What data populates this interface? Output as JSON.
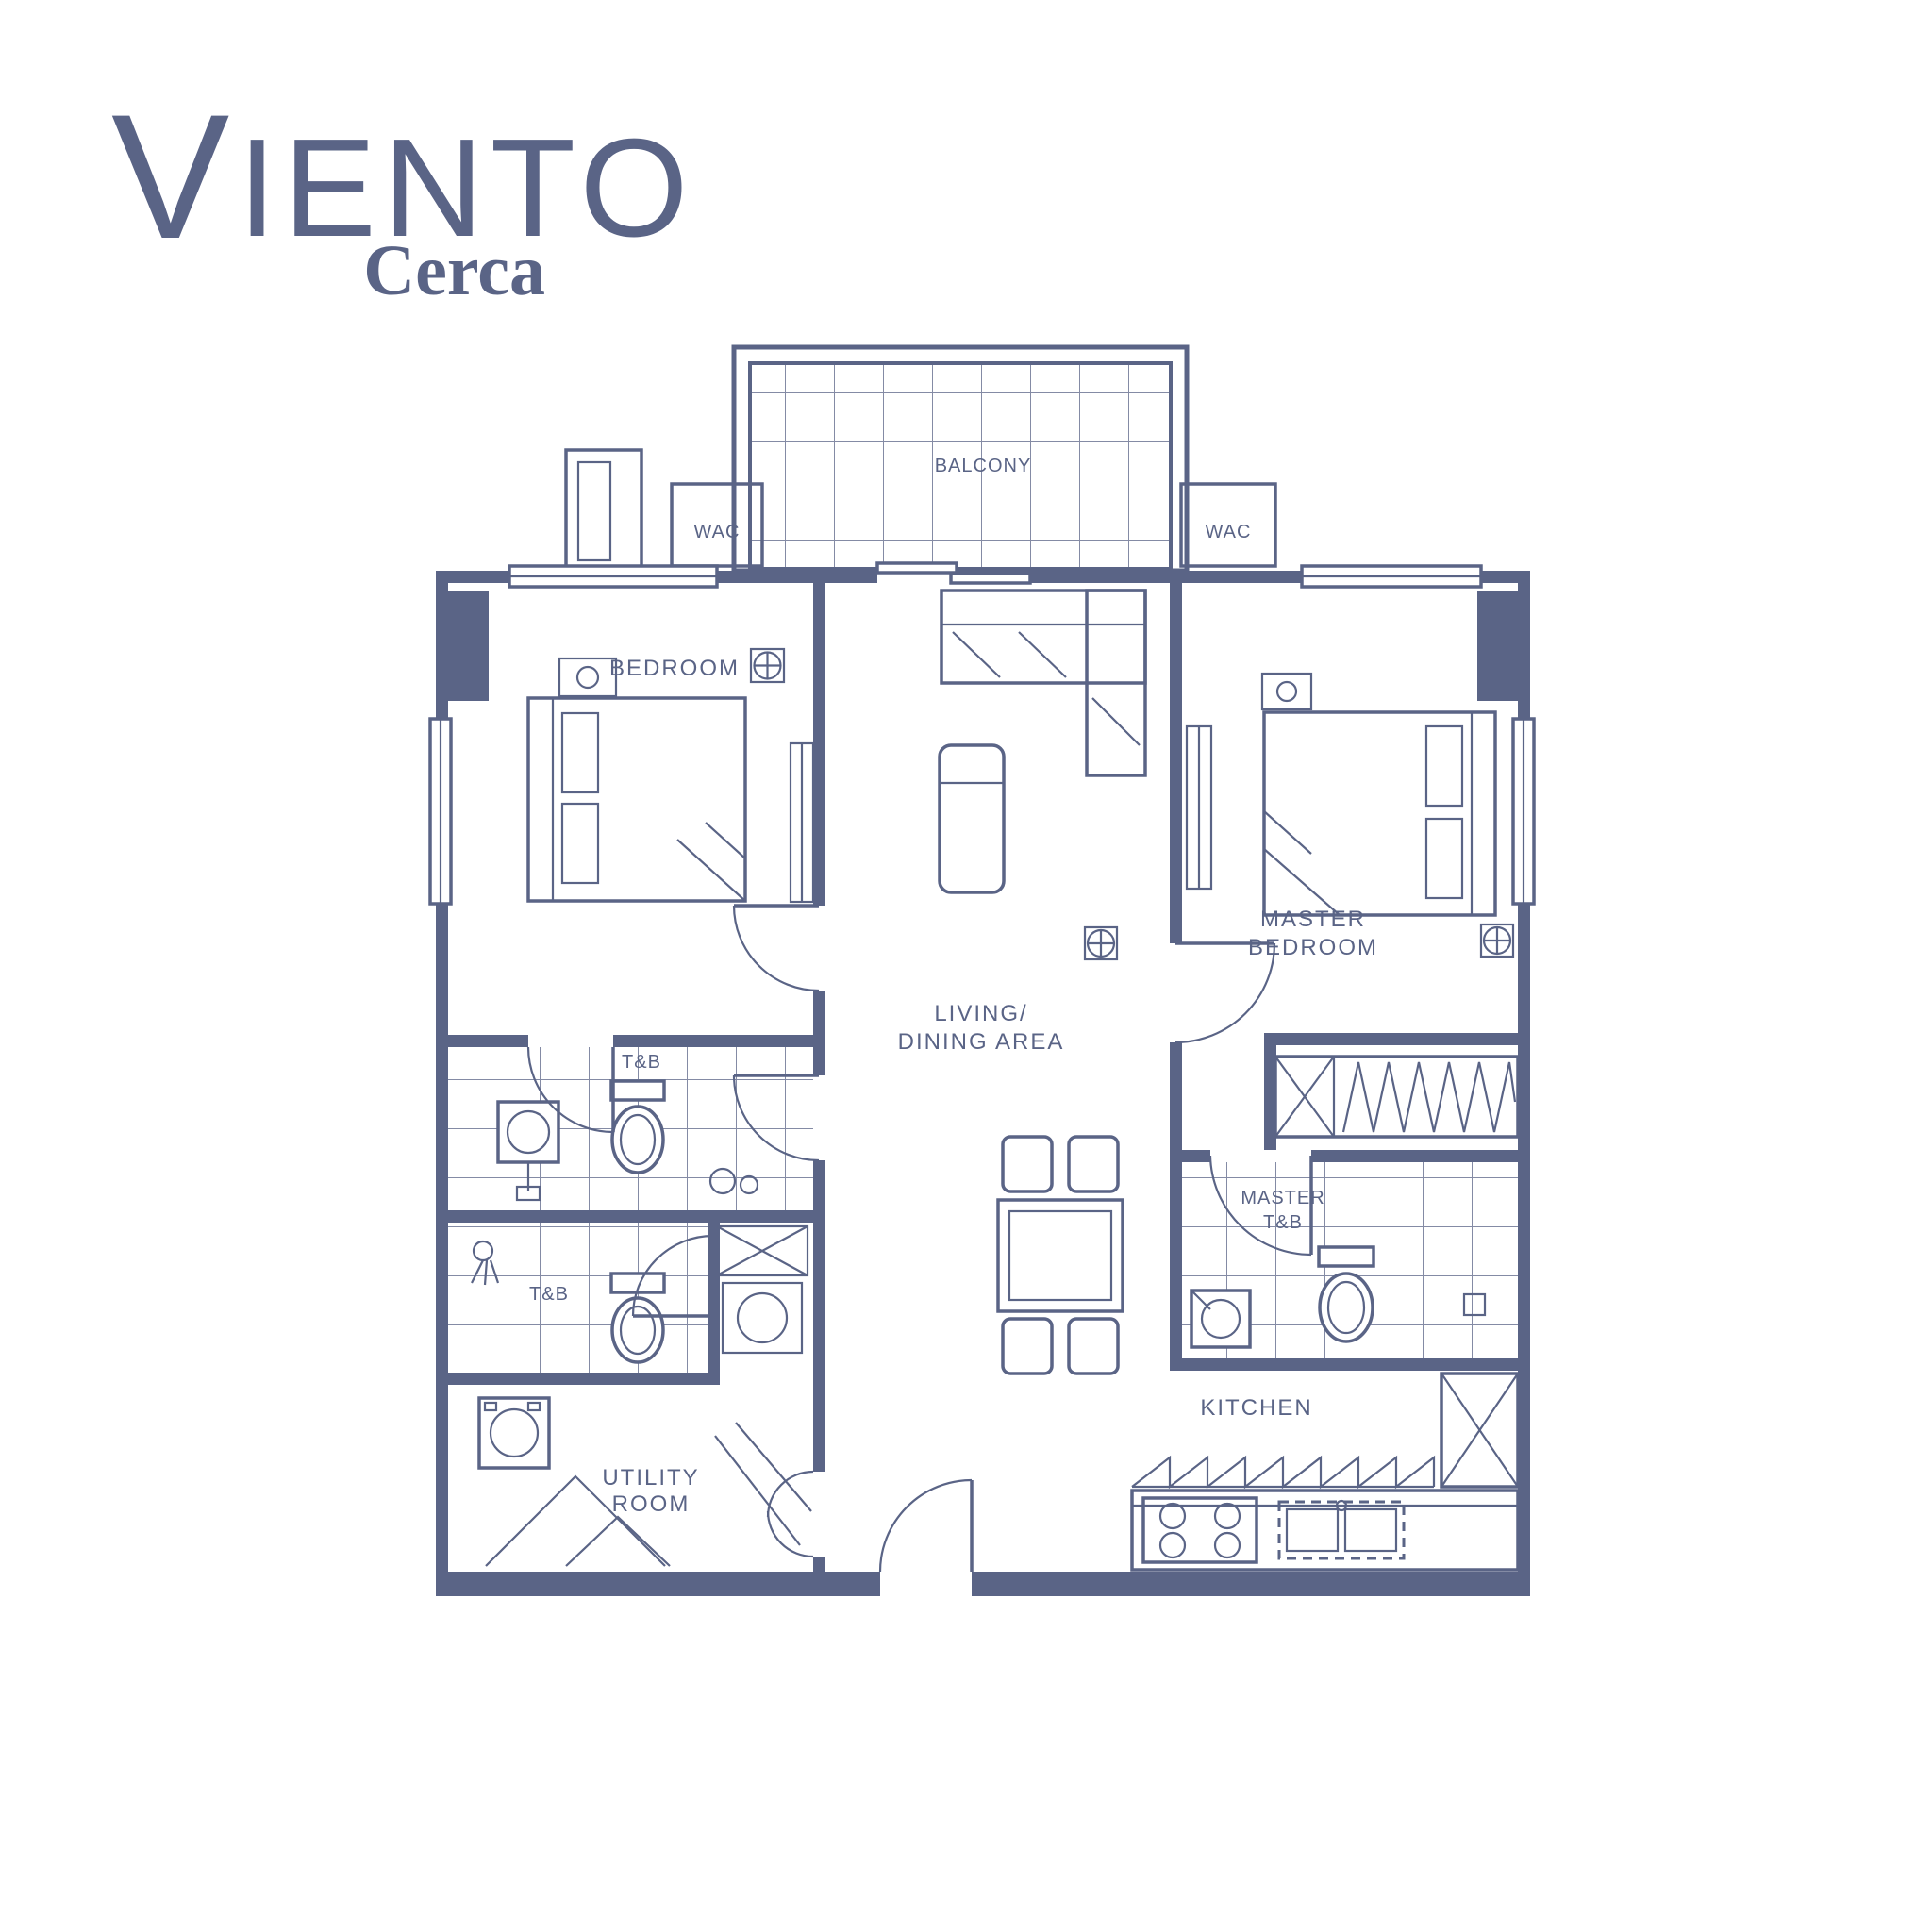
{
  "logo": {
    "title_initial": "V",
    "title_rest": "IENTO",
    "subtitle": "Cerca"
  },
  "colors": {
    "line": "#5a6486",
    "background": "#ffffff"
  },
  "rooms": {
    "balcony": "BALCONY",
    "wac_left": "WAC",
    "wac_right": "WAC",
    "bedroom": "BEDROOM",
    "master_bedroom": {
      "line1": "MASTER",
      "line2": "BEDROOM"
    },
    "living": {
      "line1": "LIVING/",
      "line2": "DINING AREA"
    },
    "common_tb": "T&B",
    "second_tb": "T&B",
    "master_tb": {
      "line1": "MASTER",
      "line2": "T&B"
    },
    "kitchen": "KITCHEN",
    "utility": {
      "line1": "UTILITY",
      "line2": "ROOM"
    }
  }
}
